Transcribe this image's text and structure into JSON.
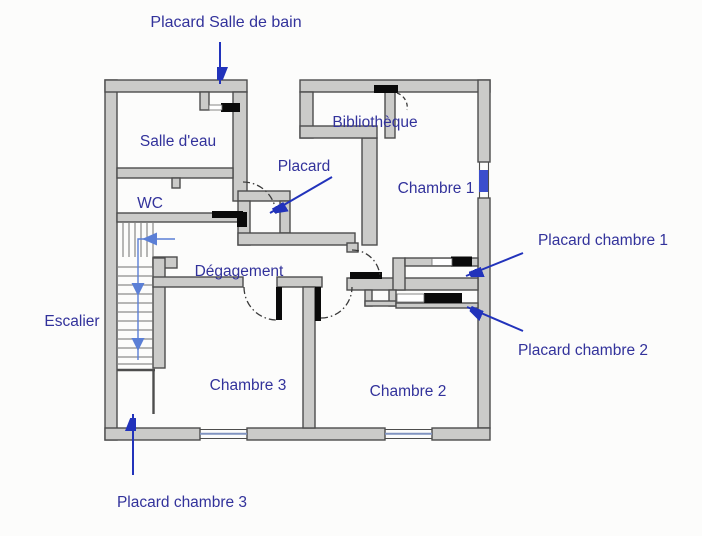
{
  "title": "Plan d'étage - floor plan",
  "labels": {
    "placard_salle_de_bain": "Placard Salle de bain",
    "salle_deau": "Salle d'eau",
    "bibliotheque": "Bibliothèque",
    "chambre_1": "Chambre 1",
    "wc": "WC",
    "placard": "Placard",
    "degagement": "Dégagement",
    "placard_chambre_1": "Placard chambre 1",
    "escalier": "Escalier",
    "placard_chambre_2": "Placard chambre 2",
    "chambre_3": "Chambre 3",
    "chambre_2": "Chambre 2",
    "placard_chambre_3": "Placard chambre 3"
  },
  "colors": {
    "background": "#fcfcfb",
    "wall_fill": "#cbcbc9",
    "wall_stroke": "#4d4d4d",
    "label_text": "#32329b",
    "annotation_arrow": "#2233bb",
    "stair_direction_arrow": "#5b7fd6",
    "door_leaf": "#0a0a0a",
    "window_glass": "#3b4ecc",
    "window_line": "#8093c0"
  }
}
